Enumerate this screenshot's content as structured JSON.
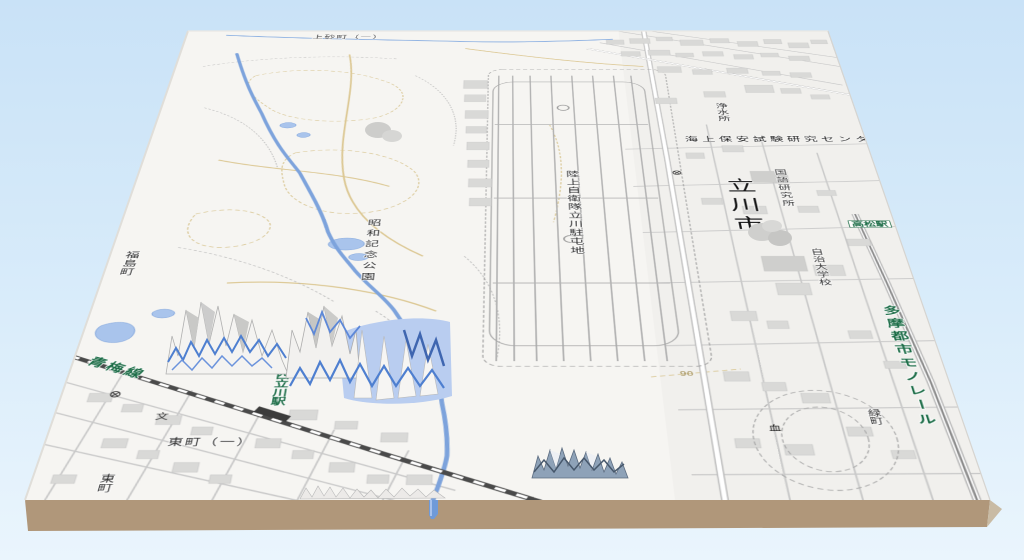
{
  "scene": {
    "description": "3D tilted terrain-block view of a Japanese GSI topographic map of Tachikawa (Showa Kinen Park / JGSDF Tachikawa garrison area) with terrain spike rendering artifacts",
    "palette": {
      "sky_top": "#c9e2f7",
      "sky_bottom": "#eaf5fd",
      "slab_front": "#b0977a",
      "slab_side": "#c9bba4",
      "map_base": "#f6f5f2",
      "water_line": "#7da3dc",
      "water_fill": "#a9c4ec",
      "road_tan": "#dcc894",
      "rail_dark": "#4a4a4a",
      "label_green": "#1a6b45",
      "label_dark": "#2b2b2b",
      "artifact_blue": "#4e7fd0"
    }
  },
  "labels": {
    "kamisunacho": "上砂町（一）",
    "josuisho": "浄水所",
    "kaijo_hoan": "海上保安試験研究センター",
    "kokugo": "国語研究所",
    "tachikawa_shi": "立川市",
    "takamatsu_station": "高松駅",
    "jichi_daigakko": "自治大学校",
    "tama_monorail": "多摩都市モノレール",
    "midoricho": "緑町",
    "rikujo_jieitai": "陸上自衛隊立川駐屯地",
    "showa_kinen_koen": "昭和記念公園",
    "fukushimacho": "福島町",
    "oume_line": "青梅線",
    "nishi_tachikawa_station": "西立川駅",
    "higashicho_itchome": "東町（一）",
    "higashicho": "東町",
    "contour_90": "90"
  },
  "icons": {
    "school": "文",
    "monument": "血"
  }
}
